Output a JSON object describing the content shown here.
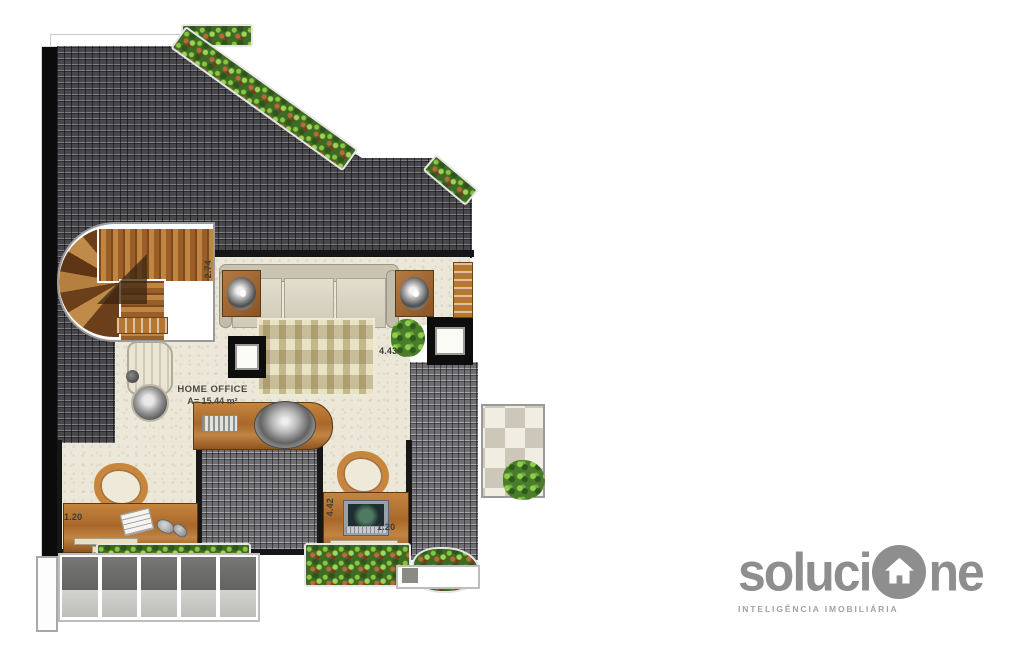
{
  "floor_plan": {
    "room": {
      "label": "HOME OFFICE",
      "area": "A= 15.44 m²"
    },
    "dimensions": [
      {
        "value": "2.74",
        "location": "stair-landing",
        "orientation": "vertical"
      },
      {
        "value": "4.43",
        "location": "living-area",
        "orientation": "horizontal"
      },
      {
        "value": "1.20",
        "location": "left-desk",
        "orientation": "horizontal"
      },
      {
        "value": "4.42",
        "location": "right-desk",
        "orientation": "vertical"
      },
      {
        "value": "1.20",
        "location": "right-desk",
        "orientation": "horizontal"
      }
    ],
    "furniture": [
      "curved-staircase",
      "sofa",
      "speaker",
      "speaker",
      "patterned-rug",
      "armchair",
      "side-table",
      "counter-with-basin",
      "keyboard",
      "skylight",
      "skylight",
      "left-desk",
      "left-chair",
      "notepad",
      "right-desk",
      "right-chair",
      "laptop",
      "tiled-terrace",
      "potted-plant",
      "flower-planters",
      "louvered-panels"
    ],
    "palette": {
      "roof_dark": "#48484c",
      "roof_mid": "#6f6f73",
      "floor": "#ece8d9",
      "wood": "#a9682a",
      "foliage": "#4a7c2c",
      "wall": "#161616"
    }
  },
  "logo": {
    "word_start": "soluci",
    "word_end": "ne",
    "icon": "house-in-circle-icon",
    "tagline": "INTELIGÊNCIA IMOBILIÁRIA",
    "color": "#8e8e8e"
  }
}
